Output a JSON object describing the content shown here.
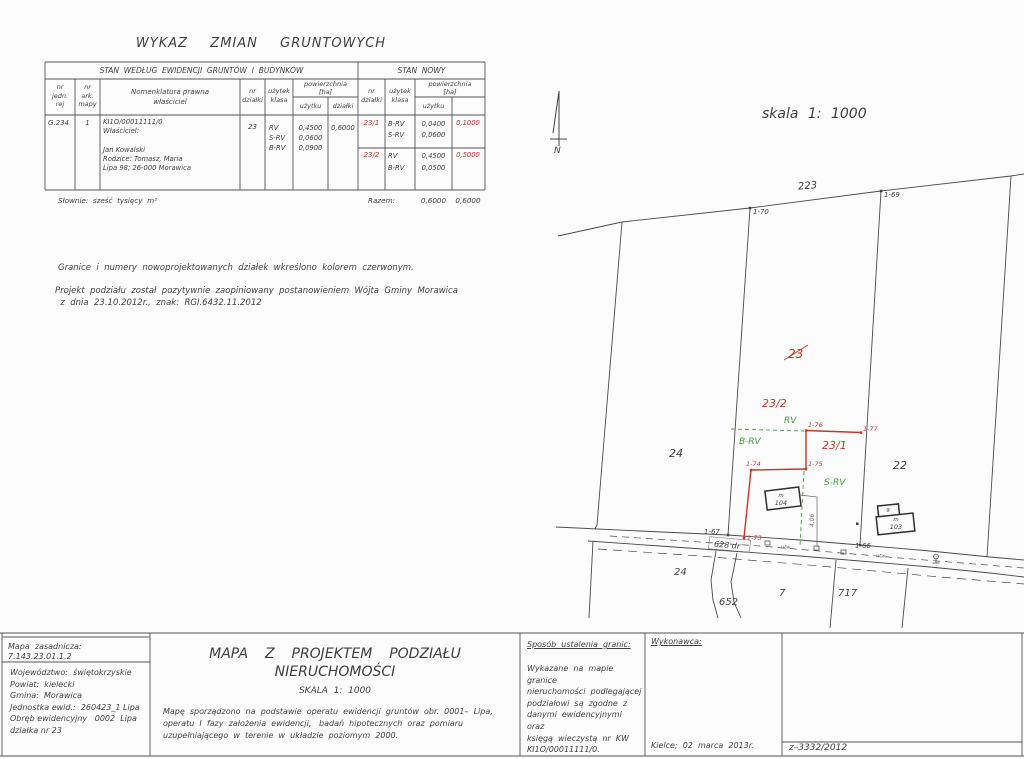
{
  "header": {
    "title": "WYKAZ  ZMIAN  GRUNTOWYCH"
  },
  "table": {
    "section_old": "STAN  WEDŁUG  EWIDENCJI  GRUNTÓW  I  BUDYNKÓW",
    "section_new": "STAN  NOWY",
    "cols": {
      "jedn": "nr\njedn.\nrej",
      "ark": "nr\nark.\nmapy",
      "nom": "Nomenklatura prawna\nwłaściciel",
      "dzialka": "nr\ndziałki",
      "uzytek": "użytek\nklasa",
      "pow": "powierzchnia\n[ha]",
      "uzytku": "użytku",
      "dzialki": "działki",
      "dzialka_n": "nr\ndziałki",
      "uzytek_n": "użytek\nklasa",
      "pow_n": "powierzchnia\n[ha]",
      "uzytku_n": "użytku"
    },
    "row": {
      "jedn": "G.234",
      "ark": "1",
      "nom": "KI1O/00011111/0\nWłaściciel:\n\nJan Kowalski\nRodzice: Tomasz, Maria\nLipa 98; 26-000 Morawica",
      "dzialka": "23",
      "uzytki": "RV\nS-RV\nB-RV",
      "pow_uzytku": "0,4500\n0,0600\n0,0900",
      "pow_dzialki": "0,6000"
    },
    "new_rows": [
      {
        "nr": "23/1",
        "klasy": "B-RV\nS-RV",
        "pow_uzytku": "0,0400\n0,0600",
        "pow_dzialki": "0,1000"
      },
      {
        "nr": "23/2",
        "klasy": "RV\nB-RV",
        "pow_uzytku": "0,4500\n0,0500",
        "pow_dzialki": "0,5000"
      }
    ],
    "slownie": "Słownie:  sześć  tysięcy  m²",
    "razem_label": "Razem:",
    "razem_uzytku": "0,6000",
    "razem_dzialki": "0,6000"
  },
  "notes": {
    "red_note": "Granice  i  numery  nowoprojektowanych  działek  wkreślono  kolorem  czerwonym.",
    "approval": "Projekt  podziału  został  pozytywnie  zaopiniowany  postanowieniem  Wójta  Gminy  Morawica\n  z  dnia  23.10.2012r.,  znak:  RGI.6432.11.2012"
  },
  "map": {
    "scale": "skala  1:  1000",
    "north": "N",
    "road_label": "628  dr",
    "dim": "4,06",
    "utw": "utw.",
    "parcels": {
      "p223": "223",
      "p24_top": "24",
      "p22": "22",
      "p23_old": "23",
      "p23_1": "23/1",
      "p23_2": "23/2",
      "p24_bottom": "24",
      "p652": "652",
      "p7": "7",
      "p717": "717"
    },
    "points": {
      "p66": "1-66",
      "p67": "1-67",
      "p69": "1-69",
      "p70": "1-70",
      "p73": "1-73",
      "p74": "1-74",
      "p75": "1-75",
      "p76": "1-76",
      "p77": "1-77"
    },
    "landuse": {
      "rv": "RV",
      "brv": "B-RV",
      "srv": "S-RV"
    },
    "buildings": {
      "b104_type": "m",
      "b104_nr": "104",
      "b9": "9",
      "b103_type": "m",
      "b103_nr": "103"
    }
  },
  "title_block": {
    "mapa_zasadnicza": "Mapa  zasadnicza:  7.143.23.01.1.2",
    "region": "Województwo:  świętokrzyskie\nPowiat:  kielecki\nGmina:  Morawica\nJednostka ewid.:  260423_1 Lipa\nObręb ewidencyjny   0002  Lipa\ndziałka nr 23",
    "title": "MAPA  Z  PROJEKTEM  PODZIAŁU  NIERUCHOMOŚCI",
    "scale": "SKALA  1:  1000",
    "desc": "Mapę  sporządzono  na  podstawie  operatu  ewidencji  gruntów  obr.  0001–  Lipa,\noperatu  I  fazy  założenia  ewidencji,   badań  hipotecznych  oraz  pomiaru\nuzupełniającego  w  terenie  w  układzie  poziomym  2000.",
    "granice_title": "Sposób  ustalenia  granic:",
    "granice_body": "Wykazane  na  mapie  granice\nnieruchomości  podlegającej\npodziałowi  są  zgodne  z\ndanymi  ewidencyjnymi  oraz\nksięgą  wieczystą  nr  KW\nKI1O/00011111/0.",
    "wykonawca_title": "Wykonawca:",
    "wykonawca_date": "Kielce;  02  marca  2013r.",
    "numer": "z–3332/2012"
  },
  "colors": {
    "red": "#c0392b",
    "green": "#3f9e3f",
    "ink": "#3f3f3f"
  }
}
